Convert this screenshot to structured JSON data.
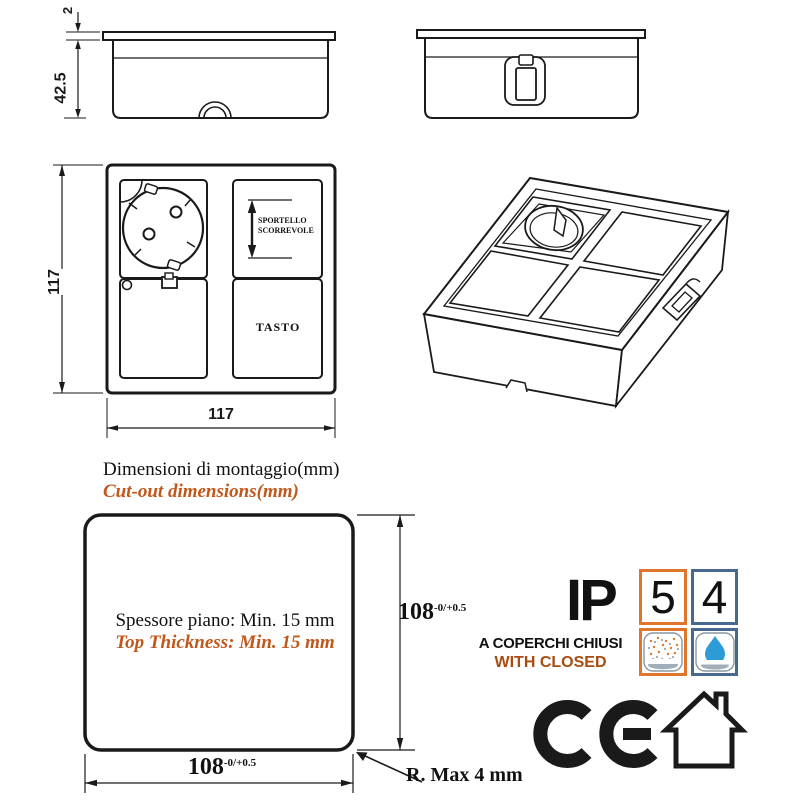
{
  "colors": {
    "line": "#1a1a1a",
    "accent_orange_text": "#c2571a",
    "ip_orange_border": "#e0762c",
    "ip_blue_border": "#47688f",
    "water_drop_blue": "#2d9bd5",
    "dish_gray": "#9faeb9"
  },
  "side_view": {
    "lip_thickness": "2",
    "height": "42.5"
  },
  "front_view": {
    "height": "117",
    "width": "117",
    "sliding_door_line1": "SPORTELLO",
    "sliding_door_line2": "SCORREVOLE",
    "button": "TASTO"
  },
  "cutout": {
    "title_it": "Dimensioni di montaggio(mm)",
    "title_en": "Cut-out dimensions(mm)",
    "thickness_it": "Spessore piano: Min. 15 mm",
    "thickness_en": "Top Thickness: Min. 15 mm",
    "width": "108",
    "width_tol": "-0/+0.5",
    "height": "108",
    "height_tol": "-0/+0.5",
    "radius_note": "R. Max 4 mm"
  },
  "ip_rating": {
    "prefix": "IP",
    "dust_digit": "5",
    "water_digit": "4",
    "note_it": "A COPERCHI CHIUSI",
    "note_en": "WITH CLOSED"
  }
}
